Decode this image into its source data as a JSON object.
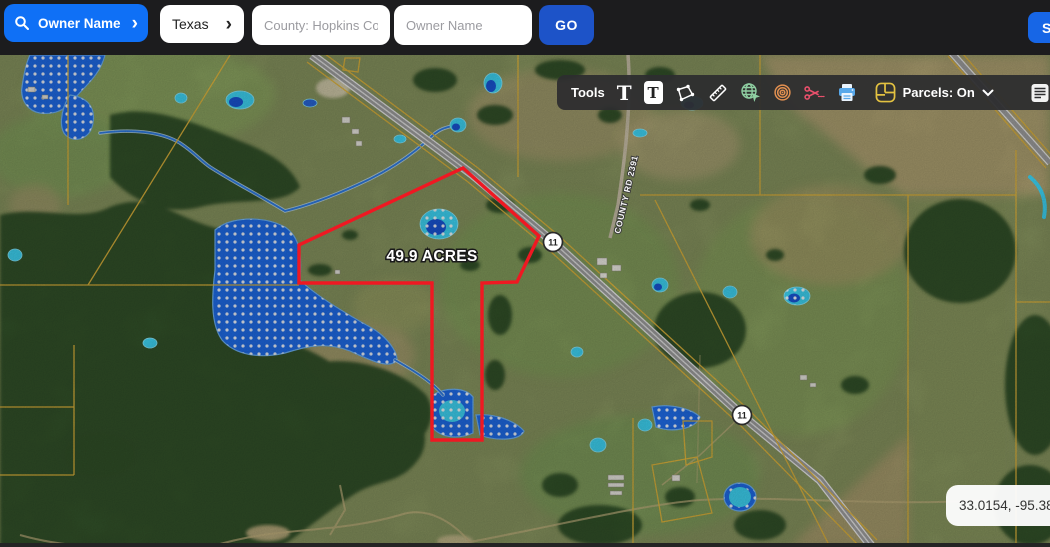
{
  "header": {
    "search_button": {
      "label": "Owner Name",
      "chevron": "›"
    },
    "state_select": {
      "value": "Texas",
      "chevron": "›"
    },
    "county_input": {
      "value": "County: Hopkins Coun"
    },
    "owner_input": {
      "placeholder": "Owner Name"
    },
    "go_button": {
      "label": "GO"
    },
    "edge_button": {
      "label": "S"
    }
  },
  "toolbar": {
    "tools_label": "Tools",
    "parcels_label": "Parcels: On",
    "reports_label": "Reports",
    "icons": [
      "text",
      "text-box",
      "polygon",
      "measure-ruler",
      "web-globe",
      "buffer-rings",
      "cut-scissors",
      "print",
      "parcels-grid",
      "report-doc"
    ]
  },
  "map": {
    "acreage_label": "49.9 ACRES",
    "road_label": "COUNTY RD 2391",
    "highway_shield": "11",
    "coordinates": "33.0154, -95.3849"
  },
  "colors": {
    "primary_blue": "#0f70f6",
    "go_blue": "#1d53c8",
    "parcel_red": "#ef1822",
    "boundary_yellow": "#e0b43c",
    "flood_blue": "#1f6ce8",
    "pond_cyan": "#3fd6f6",
    "toolbar_bg": "#2d2d2f"
  }
}
